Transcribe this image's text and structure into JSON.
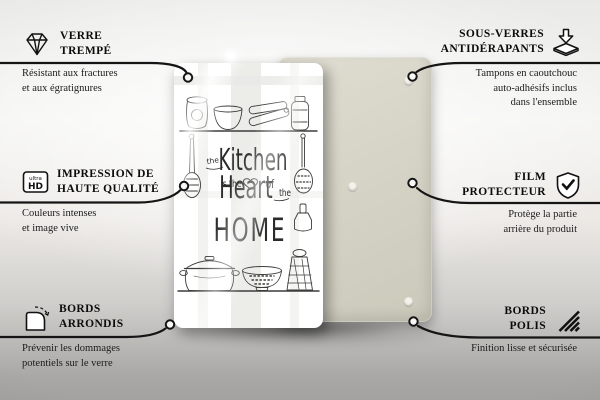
{
  "colors": {
    "connector_line": "#151515",
    "front_board": "#ffffff",
    "back_board": "#d6d4c6",
    "background_top": "#efefed",
    "background_bottom": "#a5a4a2"
  },
  "product": {
    "design": {
      "the1": "the",
      "kitchen": "Kitchen",
      "is_the": "is the",
      "of": "of",
      "heart": "Heart",
      "the2": "the",
      "home": "HOME"
    }
  },
  "callouts": {
    "left": [
      {
        "icon": "diamond-icon",
        "title_lines": [
          "VERRE",
          "TREMPÉ"
        ],
        "desc_lines": [
          "Résistant aux fractures",
          "et aux égratignures"
        ]
      },
      {
        "icon": "ultra-hd-icon",
        "icon_label_top": "ultra",
        "icon_label_bottom": "HD",
        "title_lines": [
          "IMPRESSION DE",
          "HAUTE QUALITÉ"
        ],
        "desc_lines": [
          "Couleurs intenses",
          "et image vive"
        ]
      },
      {
        "icon": "rounded-corner-icon",
        "title_lines": [
          "BORDS",
          "ARRONDIS"
        ],
        "desc_lines": [
          "Prévenir les dommages",
          "potentiels sur le verre"
        ]
      }
    ],
    "right": [
      {
        "icon": "non-slip-pads-icon",
        "title_lines": [
          "SOUS-VERRES",
          "ANTIDÉRAPANTS"
        ],
        "desc_lines": [
          "Tampons en caoutchouc",
          "auto-adhésifs inclus",
          "dans l'ensemble"
        ]
      },
      {
        "icon": "shield-check-icon",
        "title_lines": [
          "FILM",
          "PROTECTEUR"
        ],
        "desc_lines": [
          "Protège la partie",
          "arrière du produit"
        ]
      },
      {
        "icon": "polished-edge-icon",
        "title_lines": [
          "BORDS",
          "POLIS"
        ],
        "desc_lines": [
          "Finition lisse et sécurisée"
        ]
      }
    ]
  }
}
